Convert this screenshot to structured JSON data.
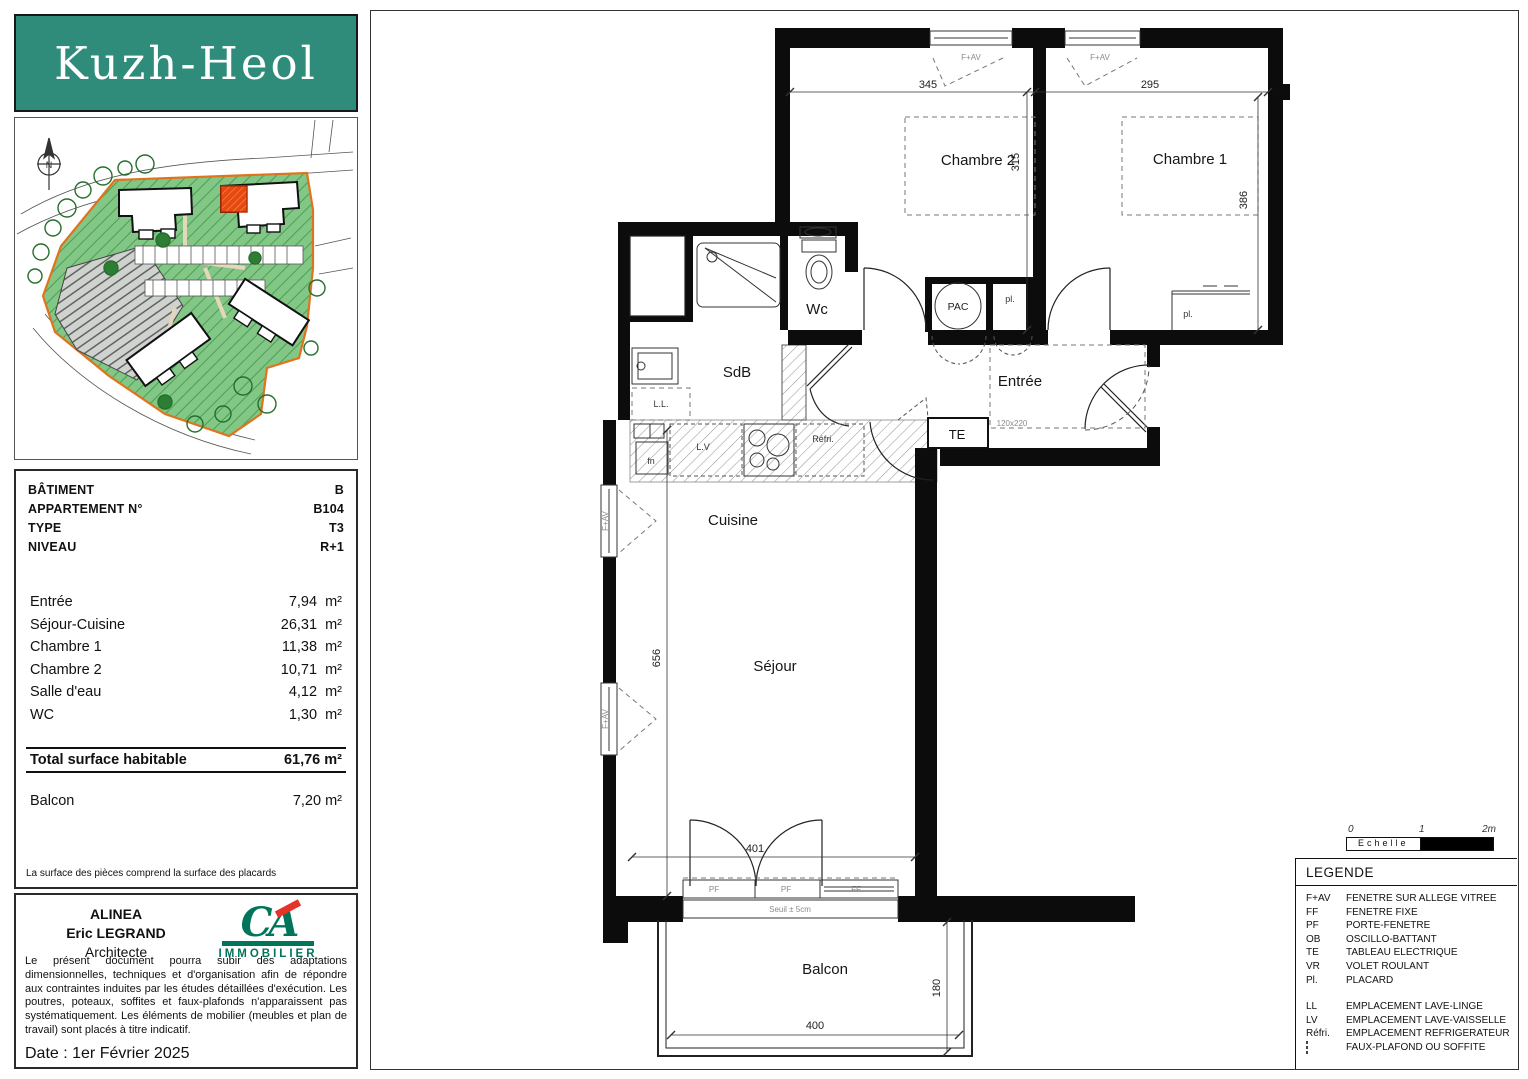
{
  "logo": {
    "title": "Kuzh-Heol",
    "bg_color": "#2f8c7b"
  },
  "site": {
    "north": "N",
    "site_green": "#82c785",
    "boundary_orange": "#e0731d",
    "highlight_red": "#e8490f"
  },
  "info": {
    "fields": [
      {
        "label": "BÂTIMENT",
        "value": "B"
      },
      {
        "label": "APPARTEMENT N°",
        "value": "B104"
      },
      {
        "label": "TYPE",
        "value": "T3"
      },
      {
        "label": "NIVEAU",
        "value": "R+1"
      }
    ],
    "areas": [
      {
        "label": "Entrée",
        "value": "7,94  m²"
      },
      {
        "label": "Séjour-Cuisine",
        "value": "26,31  m²"
      },
      {
        "label": "Chambre 1",
        "value": "11,38  m²"
      },
      {
        "label": "Chambre 2",
        "value": "10,71  m²"
      },
      {
        "label": "Salle d'eau",
        "value": "4,12  m²"
      },
      {
        "label": "WC",
        "value": "1,30  m²"
      }
    ],
    "total_label": "Total surface habitable",
    "total_value": "61,76  m²",
    "balcony_label": "Balcon",
    "balcony_value": "7,20  m²",
    "note": "La surface des pièces comprend la surface des placards"
  },
  "footer": {
    "firm": "ALINEA",
    "architect": "Eric LEGRAND",
    "role": "Architecte",
    "logo_text": "CA",
    "logo_sub": "IMMOBILIER",
    "disclaimer": "Le présent document pourra subir des adaptations dimensionnelles, techniques et d'organisation afin de répondre aux contraintes induites par les études détaillées d'exécution. Les poutres, poteaux, soffites et faux-plafonds n'apparaissent pas systématiquement. Les éléments de mobilier (meubles et plan de travail) sont placés à titre indicatif.",
    "date": "Date : 1er Février 2025"
  },
  "plan": {
    "rooms": {
      "chambre2": "Chambre 2",
      "chambre1": "Chambre 1",
      "wc": "Wc",
      "sdb": "SdB",
      "entree": "Entrée",
      "cuisine": "Cuisine",
      "sejour": "Séjour",
      "balcon": "Balcon"
    },
    "annotations": {
      "pac": "PAC",
      "te": "TE",
      "pl": "pl.",
      "ll": "L.L.",
      "fn": "fn",
      "lv": "L.V",
      "refri": "Réfri.",
      "fav": "F+AV",
      "pf": "PF",
      "ff": "FF",
      "seuil": "Seuil ± 5cm",
      "door_size": "120x220"
    },
    "dims": {
      "d345": "345",
      "d295": "295",
      "d315": "315",
      "d386": "386",
      "d656": "656",
      "d401": "401",
      "d400": "400",
      "d180": "180"
    }
  },
  "scale": {
    "label": "Echelle",
    "t0": "0",
    "t1": "1",
    "t2": "2m"
  },
  "legend": {
    "title": "LEGENDE",
    "items": [
      {
        "abbr": "F+AV",
        "desc": "FENETRE SUR ALLEGE VITREE"
      },
      {
        "abbr": "FF",
        "desc": "FENETRE FIXE"
      },
      {
        "abbr": "PF",
        "desc": "PORTE-FENETRE"
      },
      {
        "abbr": "OB",
        "desc": "OSCILLO-BATTANT"
      },
      {
        "abbr": "TE",
        "desc": "TABLEAU ELECTRIQUE"
      },
      {
        "abbr": "VR",
        "desc": "VOLET ROULANT"
      },
      {
        "abbr": "Pl.",
        "desc": "PLACARD"
      }
    ],
    "items2": [
      {
        "abbr": "LL",
        "desc": "EMPLACEMENT LAVE-LINGE"
      },
      {
        "abbr": "LV",
        "desc": "EMPLACEMENT LAVE-VAISSELLE"
      },
      {
        "abbr": "Réfri.",
        "desc": "EMPLACEMENT REFRIGERATEUR"
      },
      {
        "abbr": "",
        "icon": "faux-plafond-hatch",
        "desc": "FAUX-PLAFOND OU SOFFITE"
      }
    ]
  }
}
